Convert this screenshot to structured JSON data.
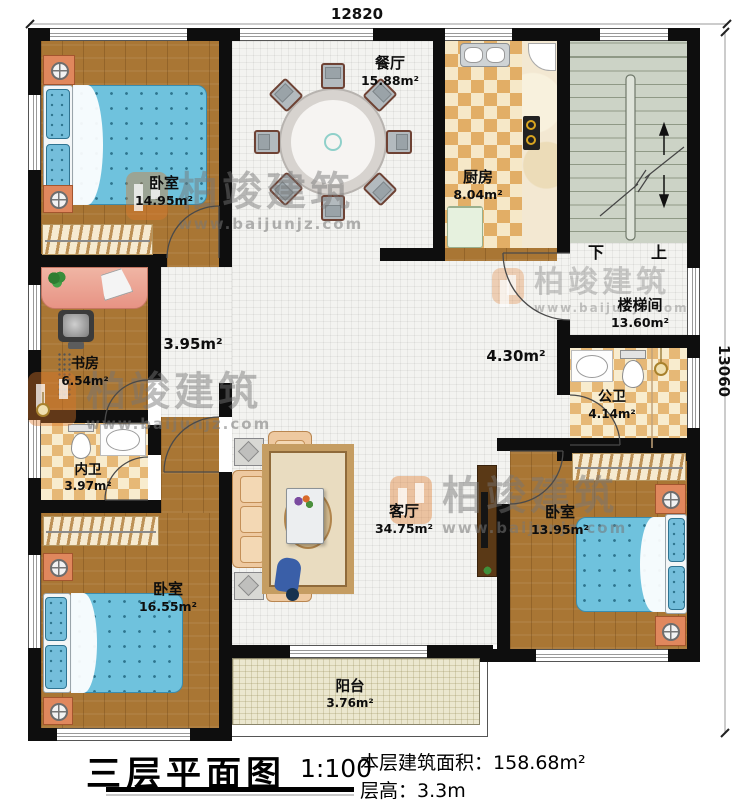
{
  "dimensions": {
    "top": "12820",
    "right": "13060"
  },
  "rooms": {
    "bedroom1": {
      "name": "卧室",
      "area": "14.95m²"
    },
    "dining": {
      "name": "餐厅",
      "area": "15.88m²"
    },
    "kitchen": {
      "name": "厨房",
      "area": "8.04m²"
    },
    "stairwell": {
      "name": "楼梯间",
      "area": "13.60m²"
    },
    "study": {
      "name": "书房",
      "area": "6.54m²"
    },
    "corridor": {
      "area": "3.95m²"
    },
    "hall": {
      "area": "4.30m²"
    },
    "bath_private": {
      "name": "内卫",
      "area": "3.97m²"
    },
    "bath_public": {
      "name": "公卫",
      "area": "4.14m²"
    },
    "bedroom2": {
      "name": "卧室",
      "area": "16.55m²"
    },
    "bedroom3": {
      "name": "卧室",
      "area": "13.95m²"
    },
    "living": {
      "name": "客厅",
      "area": "34.75m²"
    },
    "balcony": {
      "name": "阳台",
      "area": "3.76m²"
    }
  },
  "stairs": {
    "down": "下",
    "up": "上"
  },
  "titleblock": {
    "title": "三层平面图",
    "scale": "1:100",
    "floor_area_label": "本层建筑面积：",
    "floor_area": "158.68m²",
    "storey_height_label": "层高：",
    "storey_height": "3.3m"
  },
  "watermark": {
    "brand": "柏竣建筑",
    "url": "www.baijunjz.com"
  },
  "colors": {
    "wall": "#0e0e0e",
    "wood": "#a97634",
    "tile": "#f3f3f0",
    "kitchen_checker": "#e2ae66",
    "stair": "#ccd3c6",
    "balcony": "#ebe7cf",
    "bed": "#6fc2dd",
    "nightstand": "#e0875d",
    "watermark_orange": "#de7828"
  }
}
